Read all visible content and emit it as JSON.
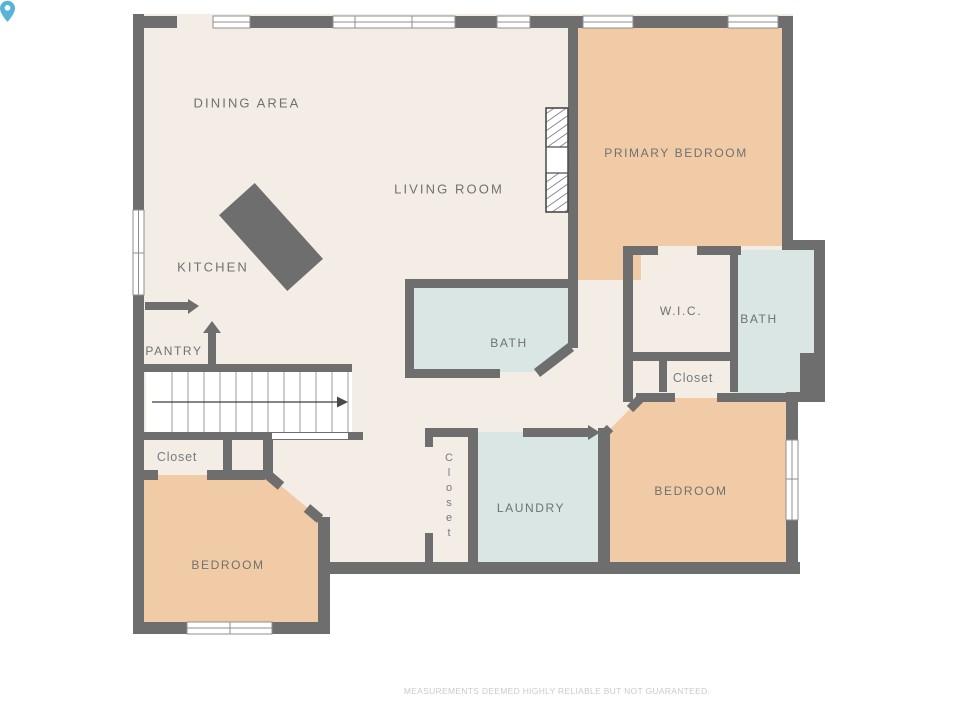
{
  "colors": {
    "wall": "#6E6E6E",
    "floor": "#F3EDE5",
    "bedroom_fill": "#F0CBA6",
    "wet_room_fill": "#D9E6E4",
    "label_text": "#6F7271",
    "disclaimer_text": "#CBCBCB",
    "pin_accent": "#58B3D8"
  },
  "rooms": {
    "dining": {
      "label": "DINING AREA"
    },
    "living": {
      "label": "LIVING ROOM"
    },
    "kitchen": {
      "label": "KITCHEN"
    },
    "pantry": {
      "label": "PANTRY"
    },
    "primary_bedroom": {
      "label": "PRIMARY BEDROOM"
    },
    "bath_main": {
      "label": "BATH"
    },
    "wic": {
      "label": "W.I.C."
    },
    "bath_ensuite": {
      "label": "BATH"
    },
    "closet_upper": {
      "label": "Closet"
    },
    "closet_left": {
      "label": "Closet"
    },
    "closet_hall": {
      "label": "Closet"
    },
    "laundry": {
      "label": "LAUNDRY"
    },
    "bedroom_right": {
      "label": "BEDROOM"
    },
    "bedroom_left": {
      "label": "BEDROOM"
    }
  },
  "footer": {
    "disclaimer": "MEASUREMENTS DEEMED HIGHLY RELIABLE BUT NOT GUARANTEED."
  }
}
